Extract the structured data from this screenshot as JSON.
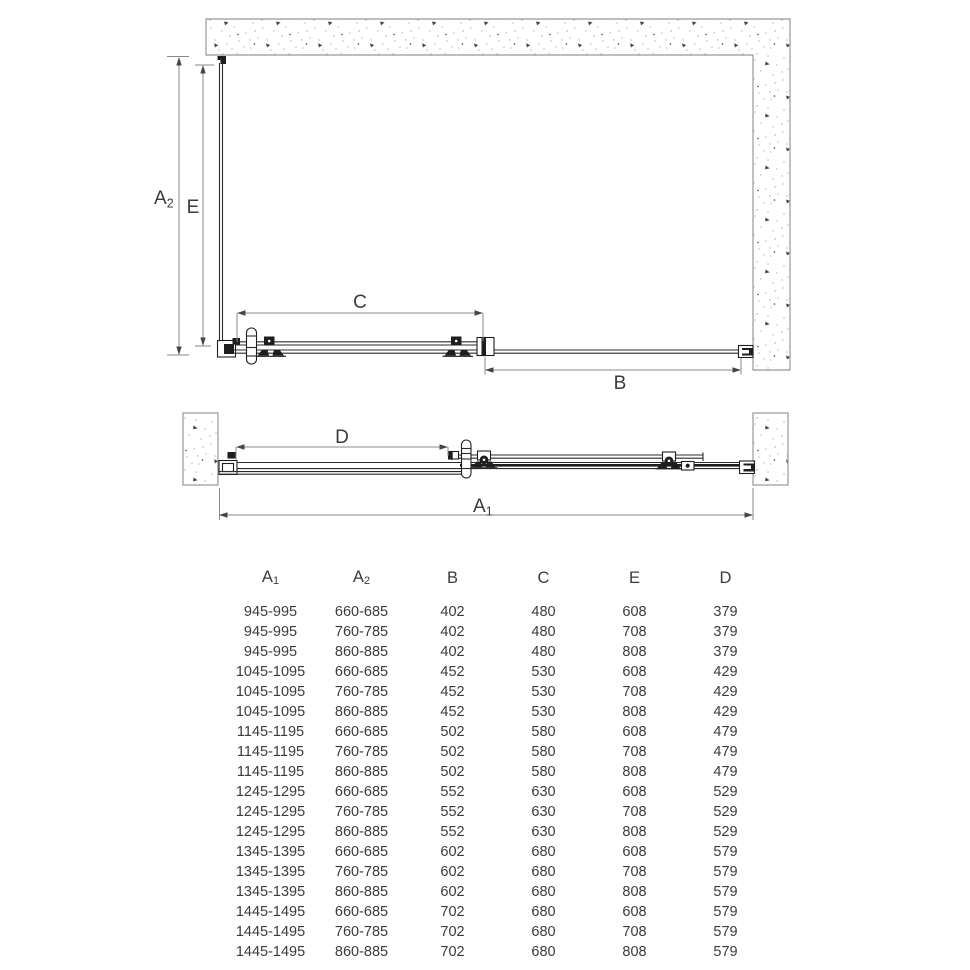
{
  "diagram": {
    "labels": {
      "a2": {
        "base": "A",
        "sub": "2"
      },
      "e": "E",
      "c": "C",
      "b": "B",
      "d": "D",
      "a1": {
        "base": "A",
        "sub": "1"
      }
    },
    "colors": {
      "dimension_line": "#8a8a8a",
      "hardware": "#1e1e1e",
      "wall_outline": "#989893",
      "text": "#3b3b3b"
    }
  },
  "table": {
    "headers": [
      {
        "base": "A",
        "sub": "1"
      },
      {
        "base": "A",
        "sub": "2"
      },
      {
        "base": "B",
        "sub": ""
      },
      {
        "base": "C",
        "sub": ""
      },
      {
        "base": "E",
        "sub": ""
      },
      {
        "base": "D",
        "sub": ""
      }
    ],
    "rows": [
      [
        "945-995",
        "660-685",
        "402",
        "480",
        "608",
        "379"
      ],
      [
        "945-995",
        "760-785",
        "402",
        "480",
        "708",
        "379"
      ],
      [
        "945-995",
        "860-885",
        "402",
        "480",
        "808",
        "379"
      ],
      [
        "1045-1095",
        "660-685",
        "452",
        "530",
        "608",
        "429"
      ],
      [
        "1045-1095",
        "760-785",
        "452",
        "530",
        "708",
        "429"
      ],
      [
        "1045-1095",
        "860-885",
        "452",
        "530",
        "808",
        "429"
      ],
      [
        "1145-1195",
        "660-685",
        "502",
        "580",
        "608",
        "479"
      ],
      [
        "1145-1195",
        "760-785",
        "502",
        "580",
        "708",
        "479"
      ],
      [
        "1145-1195",
        "860-885",
        "502",
        "580",
        "808",
        "479"
      ],
      [
        "1245-1295",
        "660-685",
        "552",
        "630",
        "608",
        "529"
      ],
      [
        "1245-1295",
        "760-785",
        "552",
        "630",
        "708",
        "529"
      ],
      [
        "1245-1295",
        "860-885",
        "552",
        "630",
        "808",
        "529"
      ],
      [
        "1345-1395",
        "660-685",
        "602",
        "680",
        "608",
        "579"
      ],
      [
        "1345-1395",
        "760-785",
        "602",
        "680",
        "708",
        "579"
      ],
      [
        "1345-1395",
        "860-885",
        "602",
        "680",
        "808",
        "579"
      ],
      [
        "1445-1495",
        "660-685",
        "702",
        "680",
        "608",
        "579"
      ],
      [
        "1445-1495",
        "760-785",
        "702",
        "680",
        "708",
        "579"
      ],
      [
        "1445-1495",
        "860-885",
        "702",
        "680",
        "808",
        "579"
      ]
    ]
  }
}
